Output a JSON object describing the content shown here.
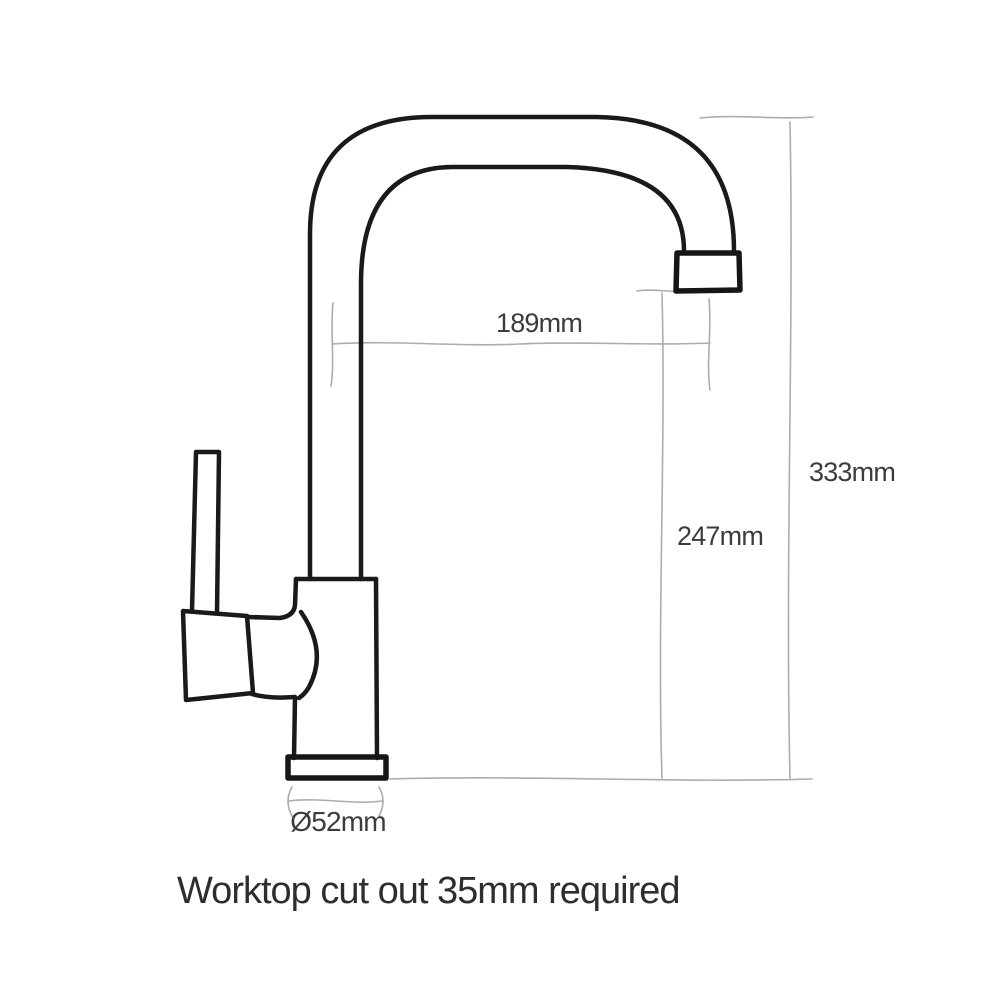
{
  "drawing": {
    "type": "technical-dimension-diagram",
    "subject": "kitchen mixer tap side elevation (hand-drawn line style)",
    "labels": {
      "spout_reach": "189mm",
      "overall_height": "333mm",
      "spout_clearance": "247mm",
      "base_diameter": "Ø52mm"
    },
    "note": "Worktop cut out 35mm required",
    "colors": {
      "outline": "#1a1a1a",
      "dimension_line": "#aeaca9",
      "label_text": "#3c3c3c",
      "note_text": "#2e2e2e",
      "background": "#ffffff"
    }
  }
}
